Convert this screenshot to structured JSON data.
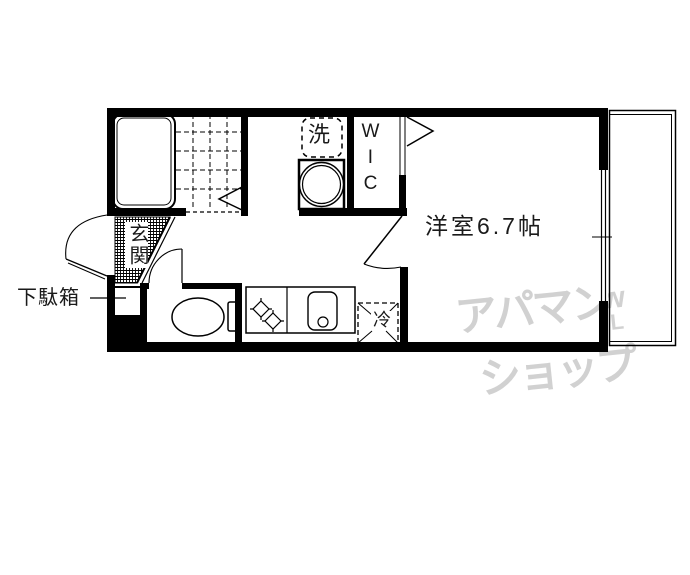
{
  "floorplan": {
    "labels": {
      "main_room": "洋室6.7帖",
      "wic": "WIC",
      "washer": "洗",
      "fridge": "冷",
      "entrance": "玄関",
      "shoe_cabinet": "下駄箱"
    },
    "watermark": {
      "line1": "アパマン",
      "line2": "ショップ",
      "logo_top": "w",
      "logo_bottom": "L"
    },
    "colors": {
      "wall": "#000000",
      "background": "#ffffff",
      "watermark": "#c9c9c9"
    }
  }
}
